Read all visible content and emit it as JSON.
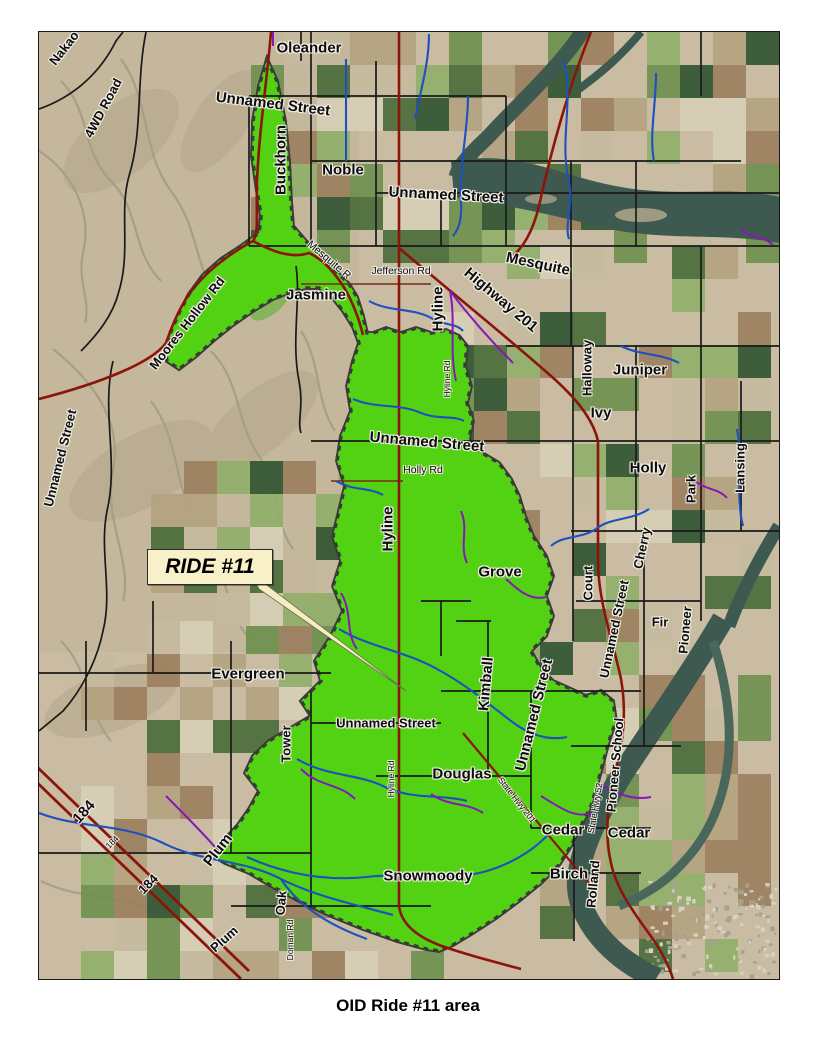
{
  "page": {
    "caption": "OID Ride #11 area"
  },
  "map": {
    "callout": {
      "label": "RIDE #11"
    },
    "colors": {
      "ride_area": "#53d214",
      "ride_area_texture": "#3fae12",
      "boundary_dash": "#d2691e",
      "canal": "#1d50c0",
      "lateral": "#8618b8",
      "highway": "#8b150b",
      "road": "#1a1a1a",
      "river": "#3e5a50",
      "desert": "#c9bca2",
      "callout_bg": "#f8f0c8",
      "field_palette": [
        "#4a6b3a",
        "#6d8f4e",
        "#2f5430",
        "#8fae6a",
        "#b3a27f",
        "#9c7f5e",
        "#c6bb9e",
        "#d6cfb6"
      ]
    },
    "labels": [
      {
        "text": "Nakao",
        "x": 25,
        "y": 16,
        "rot": -52,
        "cls": "lbl-md"
      },
      {
        "text": "4WD Road",
        "x": 64,
        "y": 76,
        "rot": -62,
        "cls": "lbl-md"
      },
      {
        "text": "Oleander",
        "x": 270,
        "y": 16,
        "rot": 0,
        "cls": "lbl-lg"
      },
      {
        "text": "Unnamed Street",
        "x": 234,
        "y": 72,
        "rot": 7,
        "cls": "lbl-lg"
      },
      {
        "text": "Buckhorn",
        "x": 242,
        "y": 128,
        "rot": -90,
        "cls": "lbl-lg"
      },
      {
        "text": "Noble",
        "x": 304,
        "y": 138,
        "rot": 0,
        "cls": "lbl-lg"
      },
      {
        "text": "Unnamed Street",
        "x": 407,
        "y": 163,
        "rot": 3,
        "cls": "lbl-lg"
      },
      {
        "text": "Mesquite",
        "x": 499,
        "y": 232,
        "rot": 12,
        "cls": "lbl-lg"
      },
      {
        "text": "Mesquite R",
        "x": 290,
        "y": 228,
        "rot": 40,
        "cls": "lbl-sm"
      },
      {
        "text": "Jefferson Rd",
        "x": 362,
        "y": 239,
        "rot": 0,
        "cls": "lbl-sm"
      },
      {
        "text": "Jasmine",
        "x": 277,
        "y": 263,
        "rot": 0,
        "cls": "lbl-lg"
      },
      {
        "text": "Moores Hollow Rd",
        "x": 148,
        "y": 291,
        "rot": -52,
        "cls": "lbl-md"
      },
      {
        "text": "Hyline",
        "x": 399,
        "y": 277,
        "rot": -90,
        "cls": "lbl-lg"
      },
      {
        "text": "Highway 201",
        "x": 462,
        "y": 268,
        "rot": 40,
        "cls": "lbl-lg"
      },
      {
        "text": "Hyline Rd",
        "x": 408,
        "y": 347,
        "rot": -90,
        "cls": "lbl-xs"
      },
      {
        "text": "Halloway",
        "x": 548,
        "y": 336,
        "rot": -90,
        "cls": "lbl-md"
      },
      {
        "text": "Juniper",
        "x": 601,
        "y": 338,
        "rot": 0,
        "cls": "lbl-lg"
      },
      {
        "text": "Ivy",
        "x": 562,
        "y": 381,
        "rot": 0,
        "cls": "lbl-lg"
      },
      {
        "text": "Unnamed Street",
        "x": 388,
        "y": 410,
        "rot": 5,
        "cls": "lbl-lg"
      },
      {
        "text": "Holly Rd",
        "x": 384,
        "y": 438,
        "rot": 0,
        "cls": "lbl-sm"
      },
      {
        "text": "Holly",
        "x": 609,
        "y": 436,
        "rot": 0,
        "cls": "lbl-lg"
      },
      {
        "text": "Park",
        "x": 652,
        "y": 457,
        "rot": -90,
        "cls": "lbl-md"
      },
      {
        "text": "Lansing",
        "x": 701,
        "y": 436,
        "rot": -90,
        "cls": "lbl-md"
      },
      {
        "text": "Unnamed Street",
        "x": 21,
        "y": 426,
        "rot": -76,
        "cls": "lbl-md"
      },
      {
        "text": "Hyline",
        "x": 349,
        "y": 497,
        "rot": -90,
        "cls": "lbl-lg"
      },
      {
        "text": "Grove",
        "x": 461,
        "y": 540,
        "rot": 0,
        "cls": "lbl-lg"
      },
      {
        "text": "Court",
        "x": 549,
        "y": 551,
        "rot": -90,
        "cls": "lbl-md"
      },
      {
        "text": "Cherry",
        "x": 603,
        "y": 516,
        "rot": -78,
        "cls": "lbl-md"
      },
      {
        "text": "Unnamed Street",
        "x": 575,
        "y": 597,
        "rot": -78,
        "cls": "lbl-md"
      },
      {
        "text": "Fir",
        "x": 621,
        "y": 590,
        "rot": 0,
        "cls": "lbl-md"
      },
      {
        "text": "Pioneer",
        "x": 646,
        "y": 598,
        "rot": -85,
        "cls": "lbl-md"
      },
      {
        "text": "Evergreen",
        "x": 209,
        "y": 642,
        "rot": 0,
        "cls": "lbl-lg"
      },
      {
        "text": "Kimball",
        "x": 447,
        "y": 652,
        "rot": -85,
        "cls": "lbl-lg"
      },
      {
        "text": "Unnamed Street",
        "x": 495,
        "y": 683,
        "rot": -76,
        "cls": "lbl-lg"
      },
      {
        "text": "Tower",
        "x": 247,
        "y": 712,
        "rot": -90,
        "cls": "lbl-md"
      },
      {
        "text": "Unnamed Street",
        "x": 347,
        "y": 691,
        "rot": 0,
        "cls": "lbl-md"
      },
      {
        "text": "Hyline Rd",
        "x": 352,
        "y": 747,
        "rot": -90,
        "cls": "lbl-xs"
      },
      {
        "text": "Douglas",
        "x": 423,
        "y": 742,
        "rot": 0,
        "cls": "lbl-lg"
      },
      {
        "text": "Pioneer School",
        "x": 576,
        "y": 733,
        "rot": -85,
        "cls": "lbl-md"
      },
      {
        "text": "State Hwy 201",
        "x": 478,
        "y": 768,
        "rot": 52,
        "cls": "lbl-xs"
      },
      {
        "text": "State Hwy 52",
        "x": 556,
        "y": 776,
        "rot": -80,
        "cls": "lbl-xs"
      },
      {
        "text": "Cedar",
        "x": 524,
        "y": 798,
        "rot": 0,
        "cls": "lbl-lg"
      },
      {
        "text": "Cedar",
        "x": 590,
        "y": 801,
        "rot": 0,
        "cls": "lbl-lg"
      },
      {
        "text": "Birch",
        "x": 530,
        "y": 842,
        "rot": 0,
        "cls": "lbl-lg"
      },
      {
        "text": "Rolland",
        "x": 554,
        "y": 852,
        "rot": -85,
        "cls": "lbl-md"
      },
      {
        "text": "Snowmoody",
        "x": 389,
        "y": 844,
        "rot": 0,
        "cls": "lbl-lg"
      },
      {
        "text": "Plum",
        "x": 179,
        "y": 818,
        "rot": -52,
        "cls": "lbl-lg"
      },
      {
        "text": "Oak",
        "x": 242,
        "y": 871,
        "rot": -85,
        "cls": "lbl-md"
      },
      {
        "text": "184",
        "x": 45,
        "y": 780,
        "rot": -48,
        "cls": "lbl-lg"
      },
      {
        "text": "184",
        "x": 73,
        "y": 810,
        "rot": -45,
        "cls": "lbl-xs"
      },
      {
        "text": "184",
        "x": 109,
        "y": 852,
        "rot": -45,
        "cls": "lbl-md"
      },
      {
        "text": "Plum",
        "x": 185,
        "y": 907,
        "rot": -42,
        "cls": "lbl-md"
      },
      {
        "text": "Doman Rd",
        "x": 251,
        "y": 908,
        "rot": -90,
        "cls": "lbl-xs"
      }
    ]
  }
}
